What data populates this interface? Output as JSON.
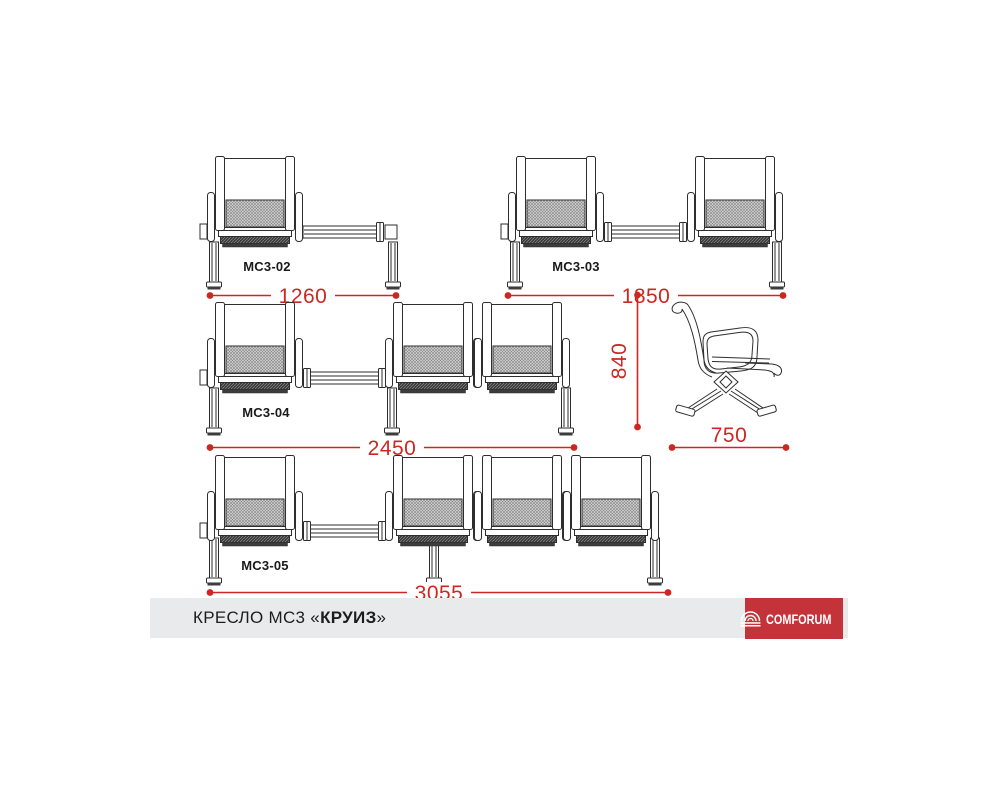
{
  "colors": {
    "dimension_red": "#cc2822",
    "logo_red": "#c43339",
    "footer_bar_gray": "#e9eaec",
    "line_color": "#2e2e2e"
  },
  "benches": [
    {
      "label": "МС3-02",
      "width": "1260",
      "seats": 1,
      "note": "seat-plus-table"
    },
    {
      "label": "МС3-03",
      "width": "1850",
      "seats": 2
    },
    {
      "label": "МС3-04",
      "width": "2450",
      "seats": 3
    },
    {
      "label": "МС3-05",
      "width": "3055",
      "seats": 4
    }
  ],
  "side_view": {
    "height": "840",
    "depth": "750"
  },
  "footer": {
    "title_prefix": "КРЕСЛО МС3 «",
    "title_name": "КРУИЗ",
    "title_suffix": "»"
  },
  "logo": {
    "text": "COMFORUM"
  }
}
